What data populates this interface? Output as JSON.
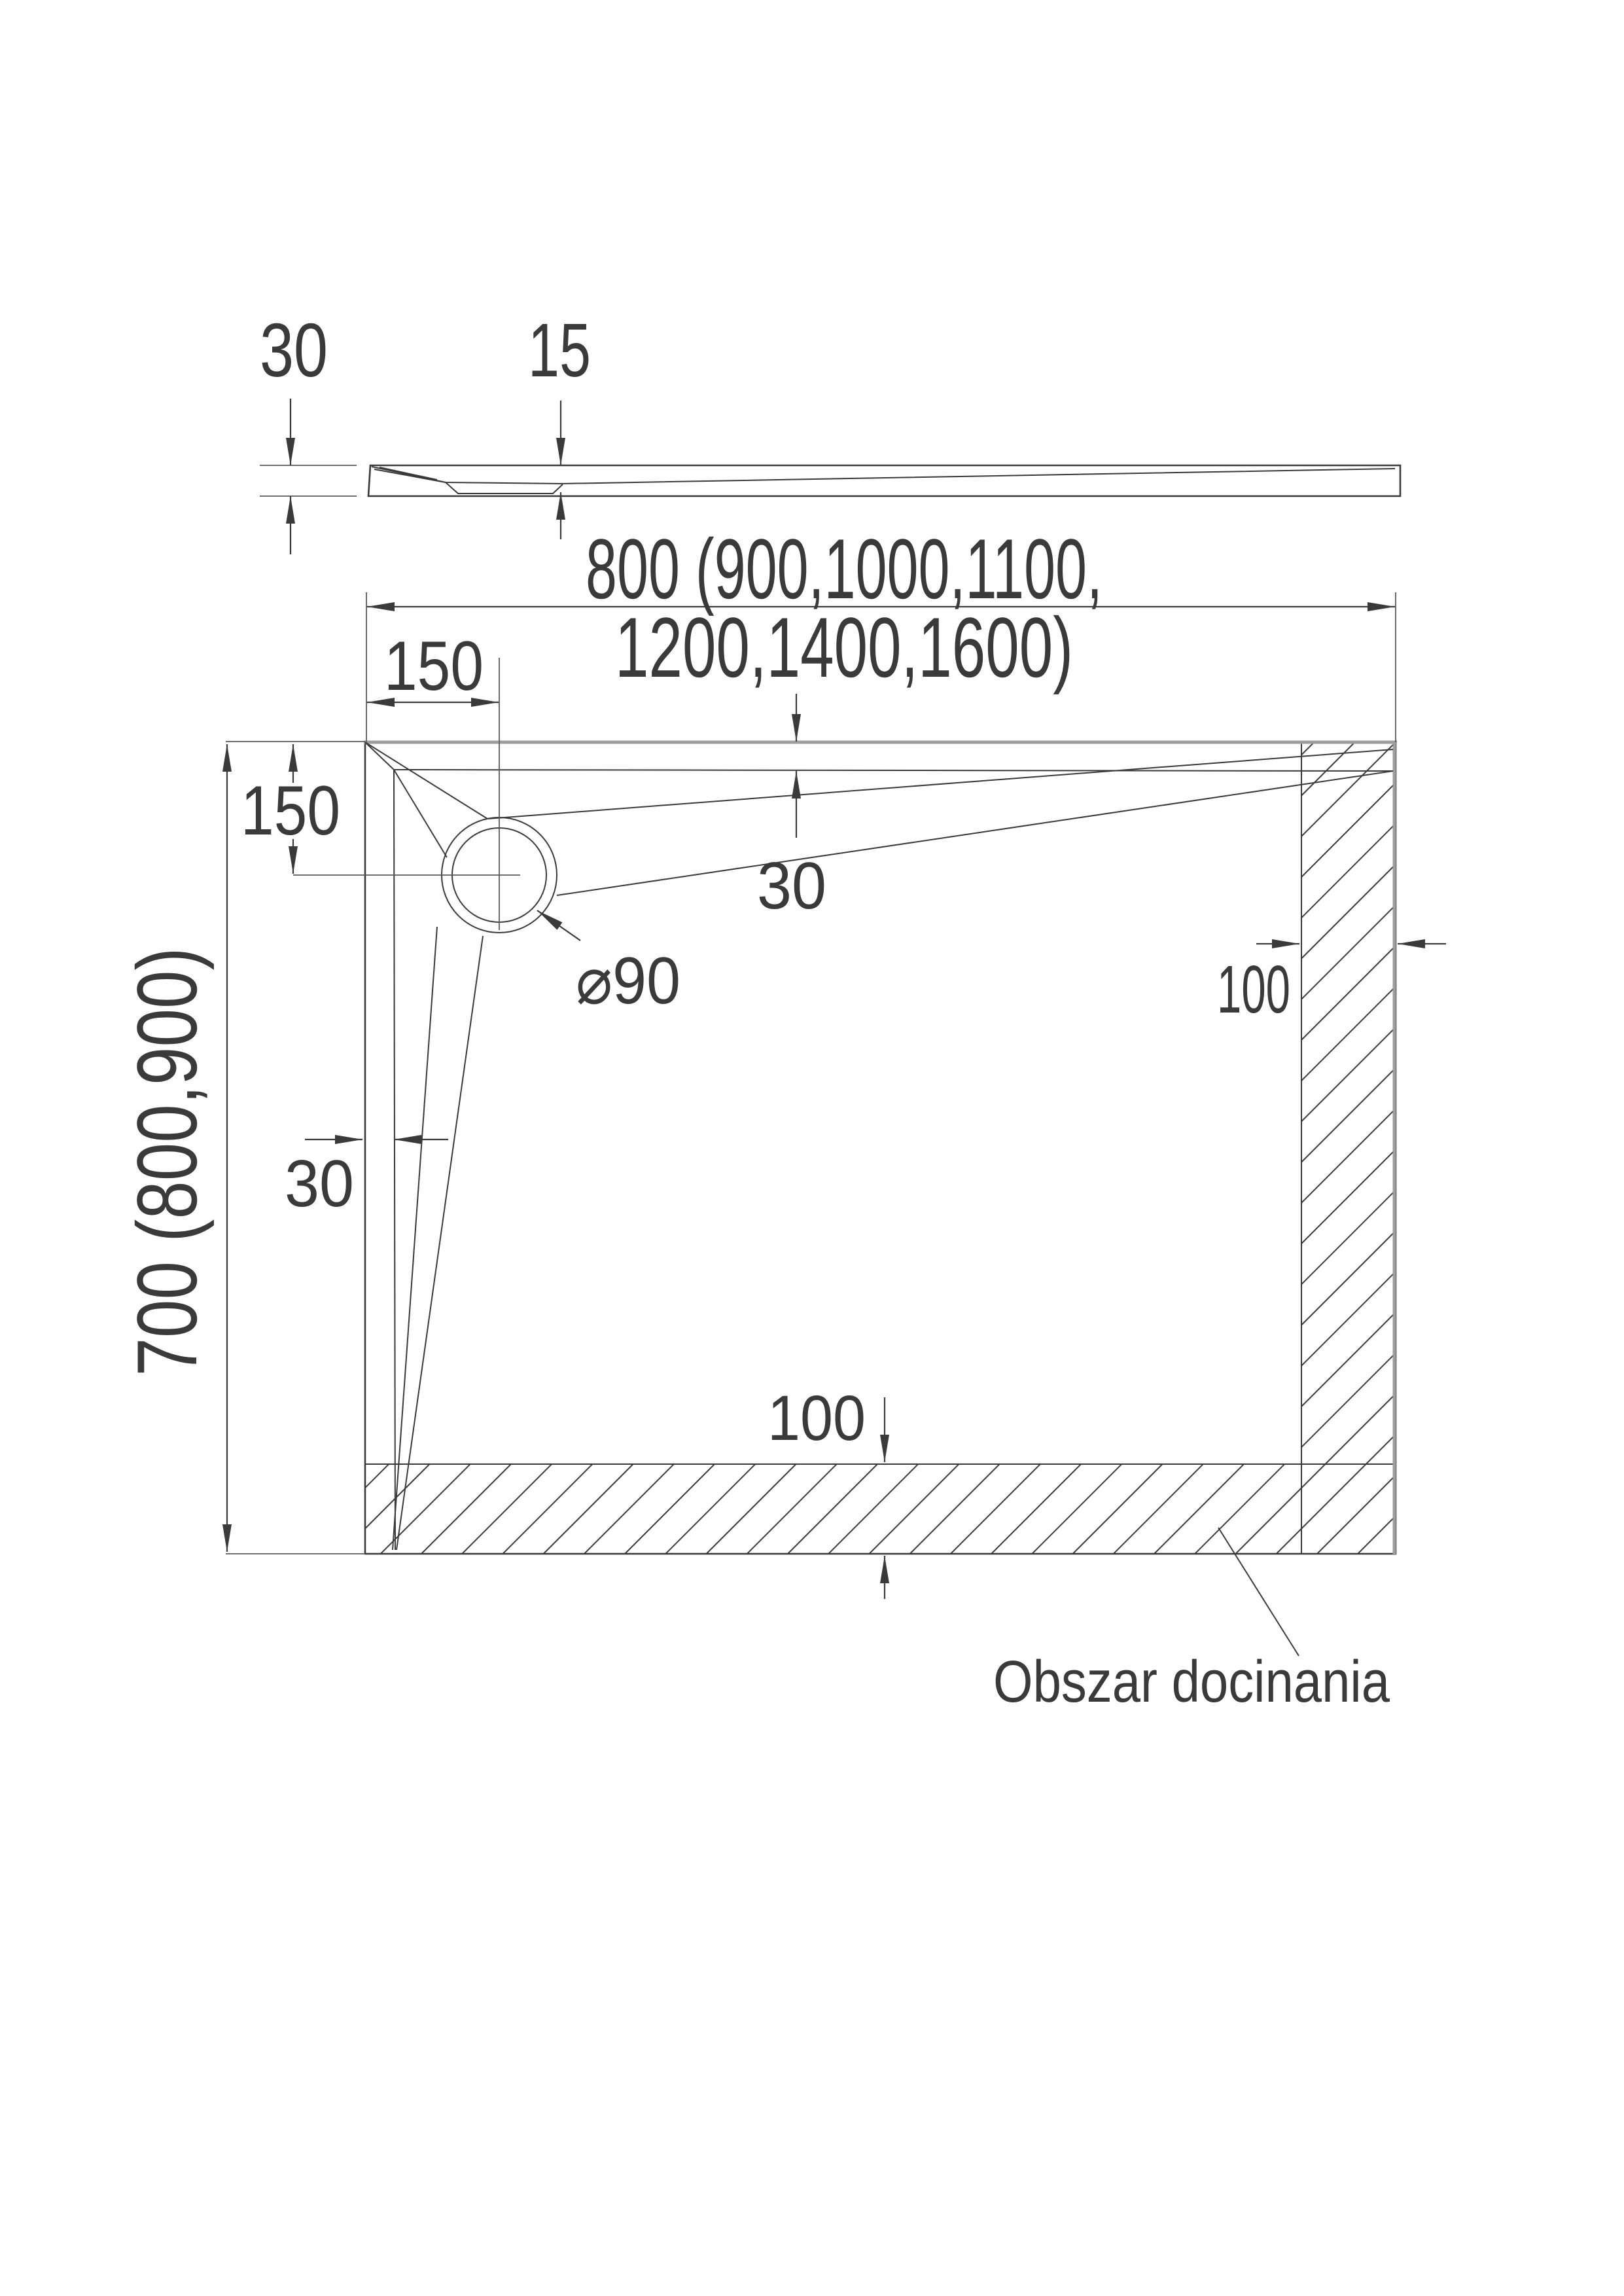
{
  "page": {
    "type": "technical-drawing",
    "language": "pl",
    "colors": {
      "ink": "#3a3a3a",
      "edge_gray": "#9e9e9e",
      "background": "#ffffff"
    },
    "side_view": {
      "thickness_label": "30",
      "depth_label": "15"
    },
    "plan": {
      "width_label_line1": "800 (900,1000,1100,",
      "width_label_line2": "1200,1400,1600)",
      "drain_offset_x": "150",
      "drain_offset_y": "150",
      "length_label": "700 (800,900)",
      "edge_gap_top": "30",
      "edge_gap_left": "30",
      "drain_diameter": "⌀90",
      "trim_width_right": "100",
      "trim_width_bottom": "100",
      "trim_area_label": "Obszar docinania"
    }
  }
}
